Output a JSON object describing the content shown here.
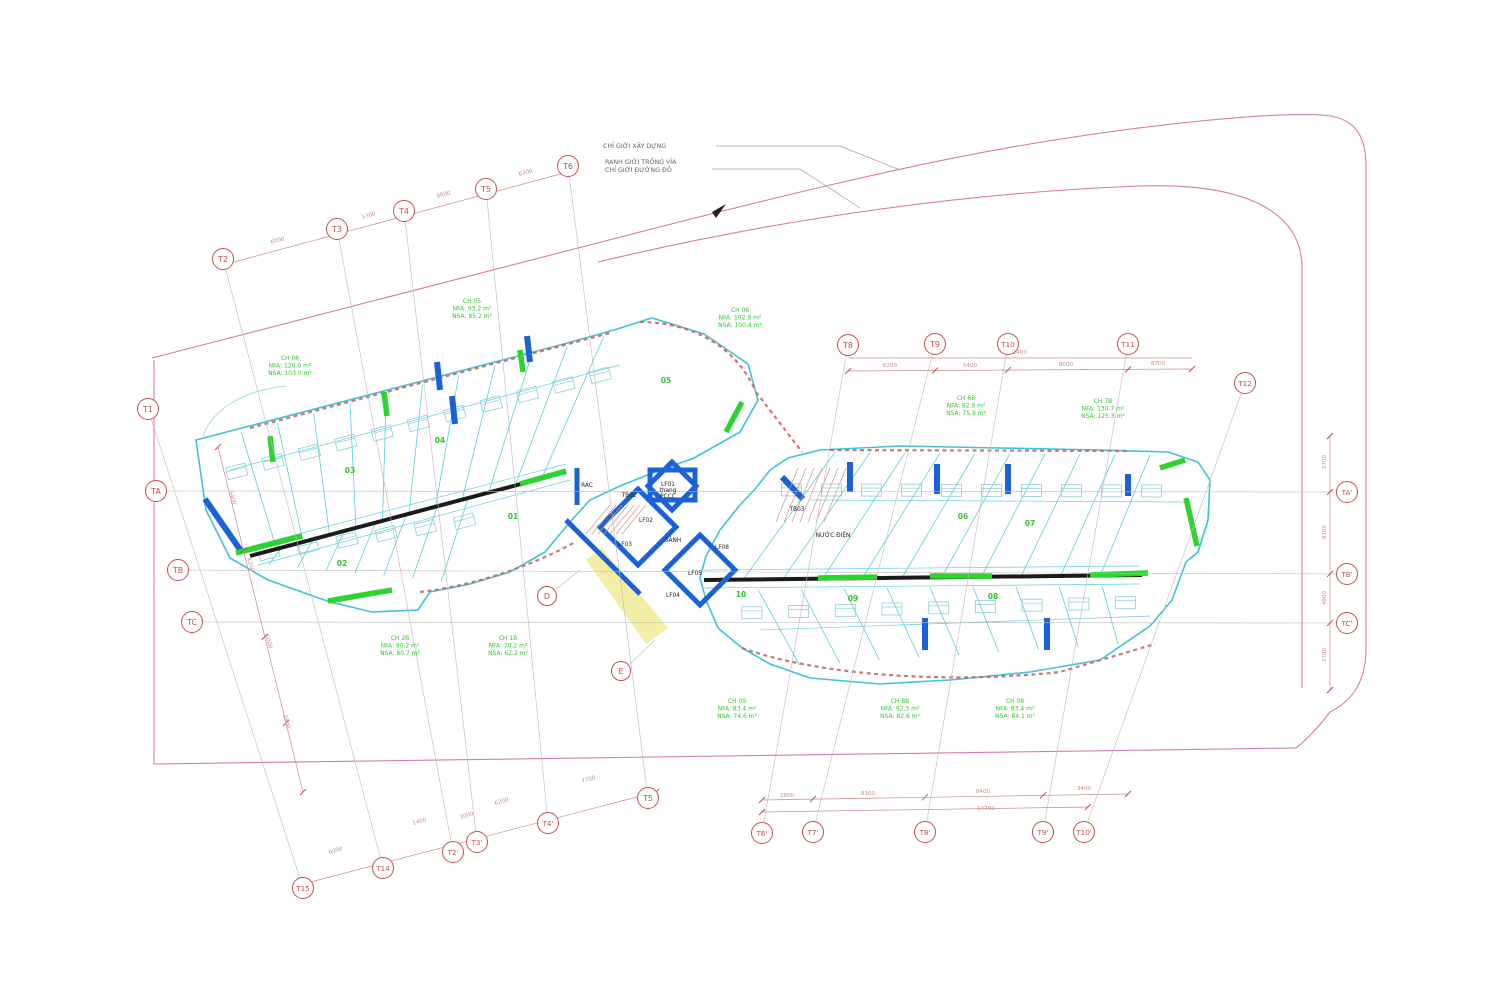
{
  "annotations": {
    "leader1": "CHỈ GIỚI XÂY DỰNG",
    "leader2": "RANH GIỚI TRỒNG VỈA",
    "leader3": "CHỈ GIỚI ĐƯỜNG ĐỎ"
  },
  "colors": {
    "grid_red": "#c0504d",
    "green": "#2fc52f",
    "cyan": "#3fc3d4",
    "cyan_light": "#8ccdd6",
    "blue": "#1a63d6",
    "pink": "#d878ae",
    "black": "#1a1a1a",
    "dim": "#c98b8b",
    "yellow": "#f2eda0",
    "scallop": "#c4605f",
    "gridline": "#b9b9b9",
    "leader_text": "#6b6257"
  },
  "grid_bubbles": [
    {
      "key": "T1",
      "label": "T1",
      "x": 148,
      "y": 409
    },
    {
      "key": "T2",
      "label": "T2",
      "x": 223,
      "y": 259
    },
    {
      "key": "T3",
      "label": "T3",
      "x": 337,
      "y": 229
    },
    {
      "key": "T4",
      "label": "T4",
      "x": 404,
      "y": 211
    },
    {
      "key": "T5",
      "label": "T5",
      "x": 486,
      "y": 189
    },
    {
      "key": "T6",
      "label": "T6",
      "x": 568,
      "y": 166
    },
    {
      "key": "TA",
      "label": "TA",
      "x": 156,
      "y": 491
    },
    {
      "key": "TB",
      "label": "TB",
      "x": 178,
      "y": 570
    },
    {
      "key": "TC",
      "label": "TC",
      "x": 192,
      "y": 622
    },
    {
      "key": "T8",
      "label": "T8",
      "x": 848,
      "y": 345
    },
    {
      "key": "T9",
      "label": "T9",
      "x": 935,
      "y": 344
    },
    {
      "key": "T10",
      "label": "T10",
      "x": 1008,
      "y": 344
    },
    {
      "key": "T11",
      "label": "T11",
      "x": 1128,
      "y": 344
    },
    {
      "key": "T12",
      "label": "T12",
      "x": 1245,
      "y": 383
    },
    {
      "key": "TAp",
      "label": "TA'",
      "x": 1347,
      "y": 492
    },
    {
      "key": "TBp",
      "label": "TB'",
      "x": 1347,
      "y": 574
    },
    {
      "key": "TCp",
      "label": "TC'",
      "x": 1347,
      "y": 623
    },
    {
      "key": "T15",
      "label": "T15",
      "x": 303,
      "y": 888
    },
    {
      "key": "T14",
      "label": "T14",
      "x": 383,
      "y": 868
    },
    {
      "key": "T2p",
      "label": "T2'",
      "x": 453,
      "y": 852
    },
    {
      "key": "T3p",
      "label": "T3'",
      "x": 477,
      "y": 842
    },
    {
      "key": "T4p",
      "label": "T4'",
      "x": 548,
      "y": 823
    },
    {
      "key": "T5b",
      "label": "T5",
      "x": 648,
      "y": 798
    },
    {
      "key": "T6p",
      "label": "T6'",
      "x": 762,
      "y": 833
    },
    {
      "key": "T7p",
      "label": "T7'",
      "x": 813,
      "y": 832
    },
    {
      "key": "T8p",
      "label": "T8'",
      "x": 925,
      "y": 832
    },
    {
      "key": "T9p",
      "label": "T9'",
      "x": 1043,
      "y": 832
    },
    {
      "key": "T10p",
      "label": "T10'",
      "x": 1084,
      "y": 832
    }
  ],
  "grid_lines": [
    [
      "T1",
      "T15"
    ],
    [
      "T2",
      "T14"
    ],
    [
      "T3",
      "T2p"
    ],
    [
      "T4",
      "T3p"
    ],
    [
      "T5",
      "T4p"
    ],
    [
      "T6",
      "T5b"
    ],
    [
      "T8",
      "T6p"
    ],
    [
      "T9",
      "T7p"
    ],
    [
      "T10",
      "T8p"
    ],
    [
      "T11",
      "T9p"
    ],
    [
      "T12",
      "T10p"
    ],
    [
      "TA",
      "TAp"
    ],
    [
      "TB",
      "TBp"
    ],
    [
      "TC",
      "TCp"
    ]
  ],
  "detail_bubbles": [
    {
      "label": "D",
      "x": 547,
      "y": 596
    },
    {
      "label": "E",
      "x": 621,
      "y": 671
    }
  ],
  "unit_numbers": [
    {
      "label": "01",
      "x": 513,
      "y": 519
    },
    {
      "label": "02",
      "x": 342,
      "y": 566
    },
    {
      "label": "03",
      "x": 350,
      "y": 473
    },
    {
      "label": "04",
      "x": 440,
      "y": 443
    },
    {
      "label": "05",
      "x": 666,
      "y": 383
    },
    {
      "label": "06",
      "x": 963,
      "y": 519
    },
    {
      "label": "07",
      "x": 1030,
      "y": 526
    },
    {
      "label": "08",
      "x": 993,
      "y": 599
    },
    {
      "label": "09",
      "x": 853,
      "y": 601
    },
    {
      "label": "10",
      "x": 741,
      "y": 597
    }
  ],
  "core_labels": [
    {
      "lines": [
        "RÁC"
      ],
      "x": 587,
      "y": 487
    },
    {
      "lines": [
        "TB02"
      ],
      "x": 629,
      "y": 497
    },
    {
      "lines": [
        "LF01",
        "thang",
        "PCCC"
      ],
      "x": 668,
      "y": 486
    },
    {
      "lines": [
        "LF02"
      ],
      "x": 646,
      "y": 522
    },
    {
      "lines": [
        "LF03"
      ],
      "x": 625,
      "y": 546
    },
    {
      "lines": [
        "SẢNH"
      ],
      "x": 673,
      "y": 542
    },
    {
      "lines": [
        "LF08"
      ],
      "x": 722,
      "y": 549
    },
    {
      "lines": [
        "LF05"
      ],
      "x": 695,
      "y": 575
    },
    {
      "lines": [
        "LF04"
      ],
      "x": 673,
      "y": 597
    },
    {
      "lines": [
        "TB03"
      ],
      "x": 797,
      "y": 511
    },
    {
      "lines": [
        "NƯỚC ĐIỆN"
      ],
      "x": 833,
      "y": 537
    }
  ],
  "apartment_labels": [
    {
      "lines": [
        "CH 06",
        "NFA: 120.0 m²",
        "NSA: 103.0 m²"
      ],
      "x": 290,
      "y": 360
    },
    {
      "lines": [
        "CH 05",
        "NFA: 93.2 m²",
        "NSA: 85.2 m²"
      ],
      "x": 472,
      "y": 303
    },
    {
      "lines": [
        "CH 06",
        "NFA: 102.9 m²",
        "NSA: 100.4 m²"
      ],
      "x": 740,
      "y": 312
    },
    {
      "lines": [
        "CH 6B",
        "NFA: 82.9 m²",
        "NSA: 75.9 m²"
      ],
      "x": 966,
      "y": 400
    },
    {
      "lines": [
        "CH 7B",
        "NFA: 130.7 m²",
        "NSA: 125.3 m²"
      ],
      "x": 1103,
      "y": 403
    },
    {
      "lines": [
        "CH 2B",
        "NFA: 90.2 m²",
        "NSA: 80.7 m²"
      ],
      "x": 400,
      "y": 640
    },
    {
      "lines": [
        "CH 1B",
        "NFA: 70.2 m²",
        "NSA: 62.2 m²"
      ],
      "x": 508,
      "y": 640
    },
    {
      "lines": [
        "CH 09",
        "NFA: 83.4 m²",
        "NSA: 74.6 m²"
      ],
      "x": 737,
      "y": 703
    },
    {
      "lines": [
        "CH 8B",
        "NFA: 92.3 m²",
        "NSA: 82.6 m²"
      ],
      "x": 900,
      "y": 703
    },
    {
      "lines": [
        "CH 08",
        "NFA: 93.4 m²",
        "NSA: 84.1 m²"
      ],
      "x": 1015,
      "y": 703
    }
  ],
  "dimensions": [
    {
      "text": "6000",
      "x": 278,
      "y": 242,
      "rot": -15
    },
    {
      "text": "5300",
      "x": 369,
      "y": 217,
      "rot": -15
    },
    {
      "text": "8000",
      "x": 444,
      "y": 196,
      "rot": -15
    },
    {
      "text": "6300",
      "x": 526,
      "y": 174,
      "rot": -15
    },
    {
      "text": "21400",
      "x": 1018,
      "y": 354,
      "rot": 0
    },
    {
      "text": "6200",
      "x": 890,
      "y": 367,
      "rot": 0
    },
    {
      "text": "5400",
      "x": 970,
      "y": 367,
      "rot": 0
    },
    {
      "text": "8000",
      "x": 1066,
      "y": 366,
      "rot": 0
    },
    {
      "text": "8700",
      "x": 1158,
      "y": 365,
      "rot": 0
    },
    {
      "text": "2800",
      "x": 787,
      "y": 797,
      "rot": 0
    },
    {
      "text": "8300",
      "x": 868,
      "y": 795,
      "rot": 0
    },
    {
      "text": "8400",
      "x": 983,
      "y": 793,
      "rot": 0
    },
    {
      "text": "3400",
      "x": 1084,
      "y": 790,
      "rot": 0
    },
    {
      "text": "14700",
      "x": 986,
      "y": 810,
      "rot": 0
    },
    {
      "text": "6000",
      "x": 336,
      "y": 852,
      "rot": -16
    },
    {
      "text": "1400",
      "x": 420,
      "y": 823,
      "rot": -16
    },
    {
      "text": "3000",
      "x": 467,
      "y": 817,
      "rot": -16
    },
    {
      "text": "6200",
      "x": 502,
      "y": 803,
      "rot": -16
    },
    {
      "text": "7700",
      "x": 589,
      "y": 781,
      "rot": -16
    },
    {
      "text": "2700",
      "x": 1326,
      "y": 462,
      "rot": -90
    },
    {
      "text": "8100",
      "x": 1326,
      "y": 532,
      "rot": -90
    },
    {
      "text": "4900",
      "x": 1326,
      "y": 598,
      "rot": -90
    },
    {
      "text": "2700",
      "x": 1326,
      "y": 655,
      "rot": -90
    },
    {
      "text": "5400",
      "x": 231,
      "y": 498,
      "rot": 74
    },
    {
      "text": "4200",
      "x": 249,
      "y": 565,
      "rot": 74
    },
    {
      "text": "6000",
      "x": 267,
      "y": 642,
      "rot": 74
    },
    {
      "text": "2800",
      "x": 285,
      "y": 722,
      "rot": 74
    }
  ]
}
